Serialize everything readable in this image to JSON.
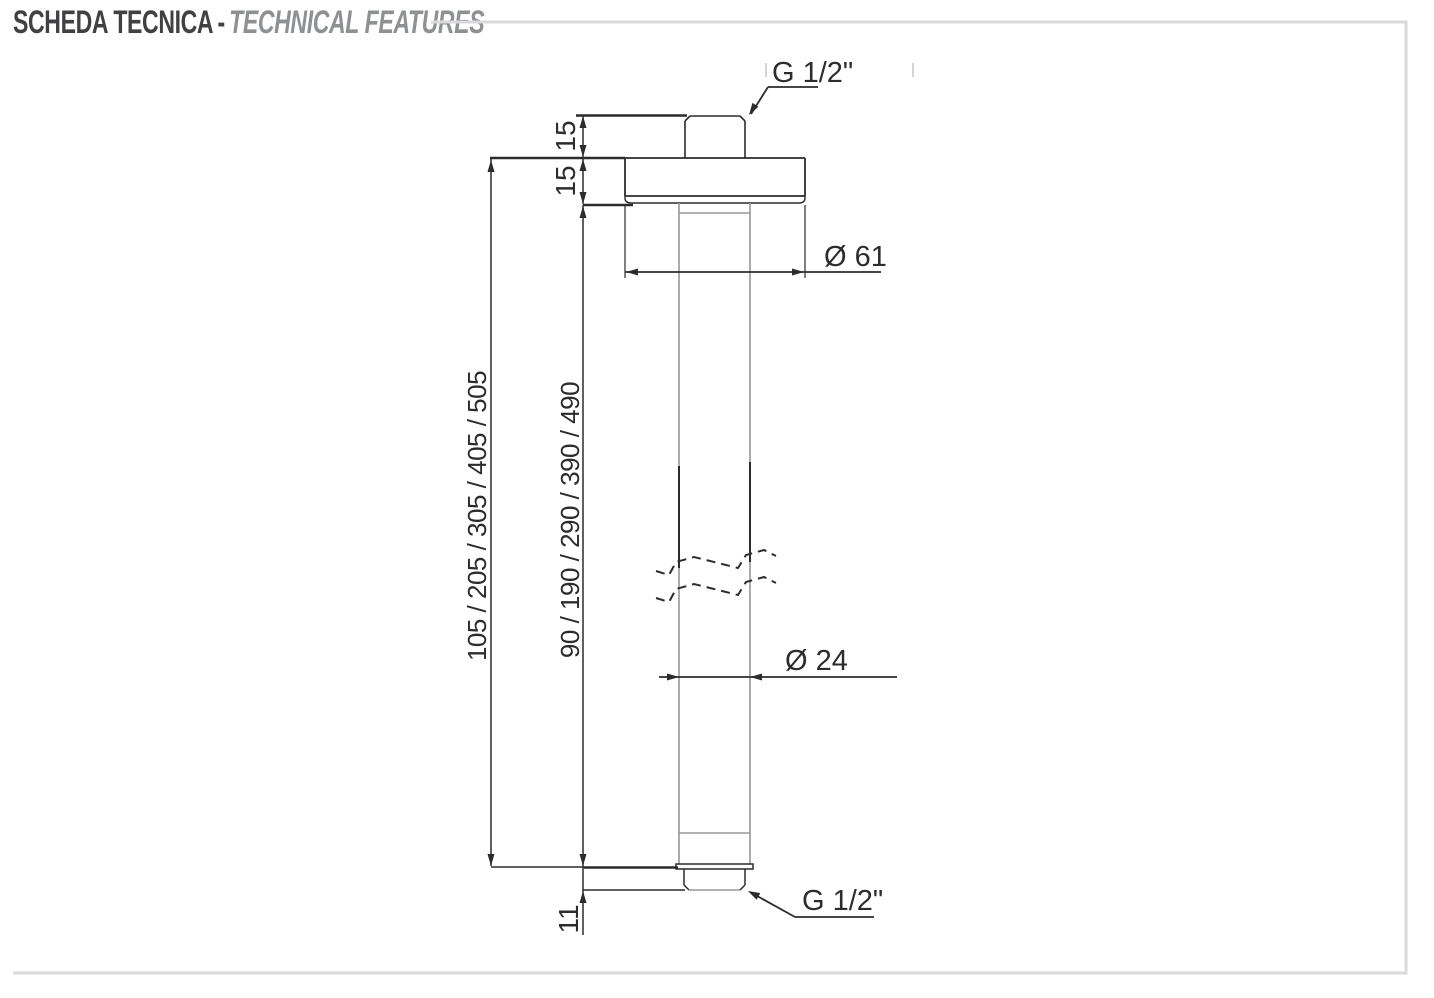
{
  "title": {
    "primary": "SCHEDA TECNICA",
    "separator": "-",
    "secondary": "TECHNICAL FEATURES"
  },
  "drawing": {
    "labels": {
      "thread_top": "G 1/2\"",
      "thread_bottom": "G 1/2\"",
      "dim_thread_top_length": "15",
      "dim_flange_height": "15",
      "dim_total_lengths": "105 / 205 / 305 / 405 / 505",
      "dim_arm_lengths": "90 / 190 / 290 / 390 / 490",
      "dim_flange_diameter": "Ø 61",
      "dim_arm_diameter": "Ø 24",
      "dim_thread_bottom_length": "11"
    },
    "colors": {
      "line_dark": "#2c2c2e",
      "line_gray": "#98989a",
      "frame_gray": "#dadadc",
      "title_dark": "#414042",
      "title_gray": "#8e9092"
    }
  }
}
